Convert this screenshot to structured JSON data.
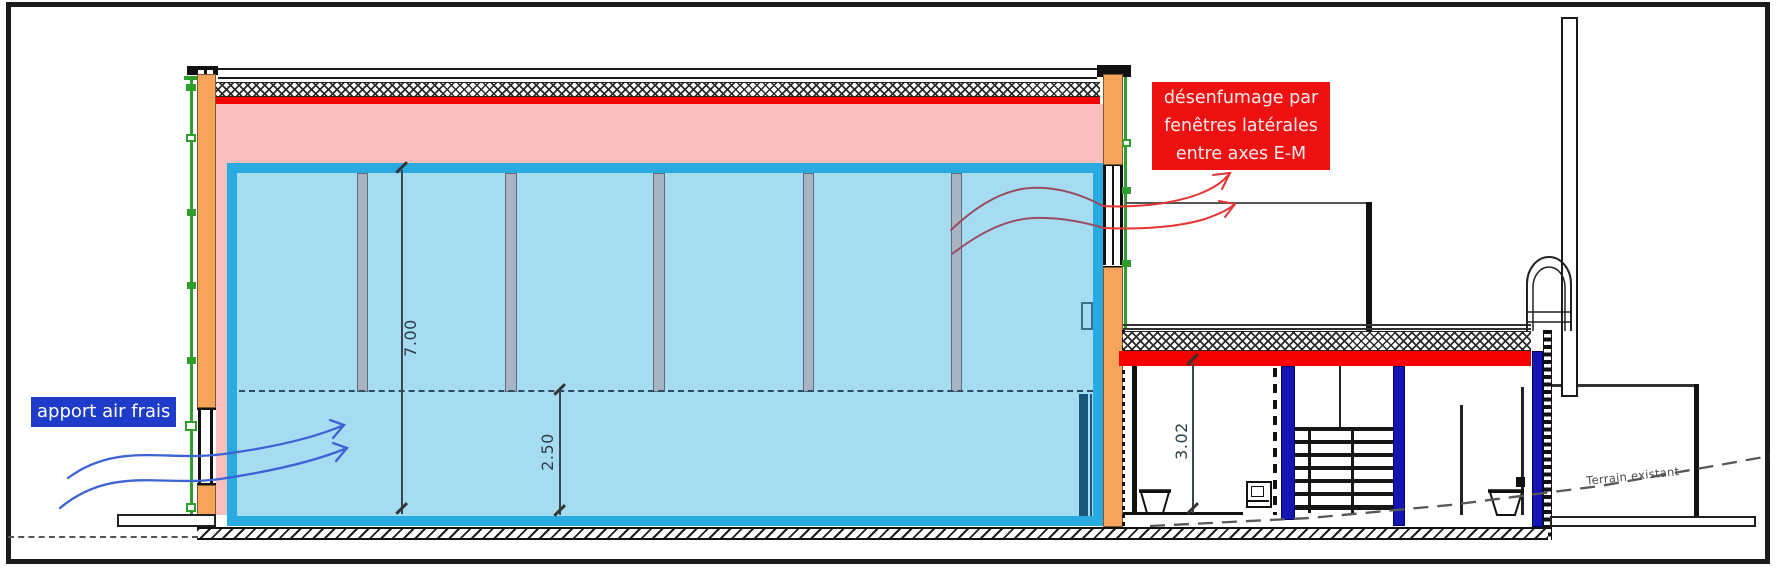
{
  "labels": {
    "fresh_air": {
      "text": "apport air frais"
    },
    "smoke": {
      "line1": "désenfumage par",
      "line2": "fenêtres latérales",
      "line3": "entre axes E-M"
    },
    "terrain": {
      "text": "Terrain existant"
    }
  },
  "dimensions": {
    "hall_total_height": "7.00",
    "hall_lower_height": "2.50",
    "annex_height": "3.02"
  },
  "colors": {
    "volume_outline": "#29abe2",
    "volume_fill": "#a6dcf1",
    "roof_space_fill": "#f9bebe",
    "structure_orange": "#f6a45c",
    "accent_red": "#f40000",
    "column_blue": "#1414b2",
    "fresh_air_label_bg": "#1e3bca",
    "smoke_label_bg": "#ee1111",
    "fresh_air_arrow": "#3c62d4",
    "smoke_arrow": "#e43434",
    "green_guide": "#2f9e2f"
  }
}
